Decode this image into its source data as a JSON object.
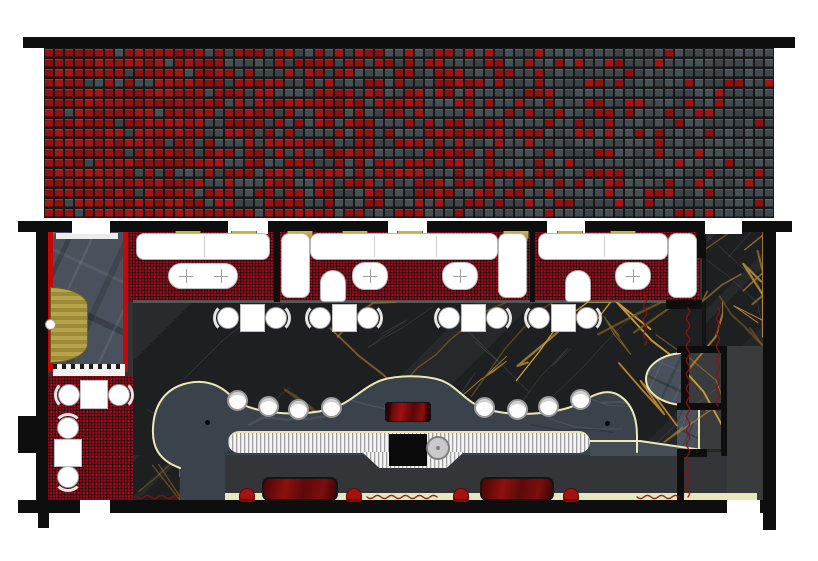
{
  "meta": {
    "type": "architectural-floor-plan",
    "subject": "restaurant-lounge interior plan with red-to-charcoal mosaic facade band, booth seating, curved bar and stage",
    "canvas": {
      "w": 818,
      "h": 561
    },
    "render_seed": 1337
  },
  "palette": {
    "wall": "#0e0e0e",
    "mosaic_red": "#9b1212",
    "mosaic_gray": "#424b4f",
    "mosaic_grout": "#161819",
    "carpet_red": "#850e1b",
    "marble_black": "#1d1f21",
    "marble_gold_vein": "#b8862e",
    "slate_gray": "#49525c",
    "service_gray": "#333538",
    "corridor_gray": "#3a3b3d",
    "cream_outline": "#ece9b6",
    "banquette_yellow": "#e4e7bf",
    "furniture_white": "#ffffff",
    "glossy_bench_red": "#8e1010",
    "stool_red": "#a51310",
    "door_gold": "#b7a34b",
    "metal_counter": "#dcdcdc"
  },
  "inventory": {
    "mosaic_band": "gradient tile mosaic, red at left fading to charcoal at right",
    "booth_sections": 3,
    "booth_wall_lamps": 8,
    "booth_oval_tables": 4,
    "booth_arch_chairs": 2,
    "dining_table_sets": 4,
    "side_room_tables": 2,
    "bar_stools": 8,
    "lounge_benches": 2,
    "lounge_floor_stools": 4,
    "stage_semicircles": 1,
    "entry_door_swings": 1,
    "top_door_openings": 5,
    "bottom_door_openings": 2
  },
  "mosaic": {
    "x": 44,
    "y": 48,
    "w": 730,
    "h": 170,
    "cols": 73,
    "rows": 17,
    "red_shades": [
      "#9b1212",
      "#8c1010",
      "#a41616",
      "#931111"
    ],
    "gray_shades": [
      "#424b4f",
      "#3b4347",
      "#475054",
      "#3f474b"
    ],
    "red_fraction_left": 0.97,
    "red_fraction_right": 0.04
  },
  "structure": {
    "zones": [
      {
        "name": "interior-floor-base",
        "x": 48,
        "y": 231,
        "w": 719,
        "h": 274,
        "css": "flat1"
      },
      {
        "name": "vestibule-floor",
        "x": 53,
        "y": 232,
        "w": 70,
        "h": 140,
        "css": "slate"
      },
      {
        "name": "vestibule-red-wall-left",
        "x": 48,
        "y": 232,
        "w": 5,
        "h": 140,
        "css": "redstrip"
      },
      {
        "name": "vestibule-red-wall-right",
        "x": 123,
        "y": 232,
        "w": 5,
        "h": 140,
        "css": "redstrip"
      },
      {
        "name": "vestibule-entry-mat",
        "x": 56,
        "y": 233,
        "w": 62,
        "h": 6,
        "css": "mat"
      },
      {
        "name": "vestibule-threshold",
        "x": 53,
        "y": 364,
        "w": 72,
        "h": 12,
        "css": "threshold"
      },
      {
        "name": "booth-carpet",
        "x": 128,
        "y": 232,
        "w": 572,
        "h": 70,
        "css": "carpet"
      },
      {
        "name": "marble-dining-floor",
        "x": 133,
        "y": 302,
        "w": 590,
        "h": 153,
        "css": "marble"
      },
      {
        "name": "marble-right-panel",
        "x": 702,
        "y": 230,
        "w": 61,
        "h": 116,
        "css": "marble panelL"
      },
      {
        "name": "carpet-edge-line",
        "x": 133,
        "y": 300,
        "w": 567,
        "h": 3,
        "css": "line"
      },
      {
        "name": "side-room-carpet",
        "x": 48,
        "y": 376,
        "w": 85,
        "h": 124,
        "css": "carpet"
      },
      {
        "name": "marble-walkway",
        "x": 133,
        "y": 455,
        "w": 47,
        "h": 45,
        "css": "marble"
      },
      {
        "name": "service-lounge-floor",
        "x": 225,
        "y": 452,
        "w": 532,
        "h": 53,
        "css": "flat2"
      },
      {
        "name": "east-corridor-floor",
        "x": 727,
        "y": 346,
        "w": 36,
        "h": 159,
        "css": "flat3"
      },
      {
        "name": "alcove-1-floor",
        "x": 689,
        "y": 353,
        "w": 32,
        "h": 50,
        "css": "flat3"
      },
      {
        "name": "alcove-2-slate",
        "x": 677,
        "y": 410,
        "w": 23,
        "h": 39,
        "css": "slate alc-slate"
      },
      {
        "name": "alcove-2-floor",
        "x": 700,
        "y": 410,
        "w": 21,
        "h": 39,
        "css": "flat3"
      },
      {
        "name": "banquette-strip",
        "x": 225,
        "y": 493,
        "w": 532,
        "h": 11,
        "css": "banq"
      }
    ],
    "walls": [
      {
        "name": "top-facade-wall",
        "x": 23,
        "y": 37,
        "w": 772,
        "h": 11
      },
      {
        "name": "interior-top-wall",
        "x": 18,
        "y": 221,
        "w": 774,
        "h": 11
      },
      {
        "name": "bottom-wall",
        "x": 18,
        "y": 500,
        "w": 745,
        "h": 13
      },
      {
        "name": "left-wall",
        "x": 36,
        "y": 231,
        "w": 12,
        "h": 269
      },
      {
        "name": "left-pillar",
        "x": 18,
        "y": 416,
        "w": 18,
        "h": 37
      },
      {
        "name": "left-wall-stub",
        "x": 38,
        "y": 513,
        "w": 11,
        "h": 15
      },
      {
        "name": "right-wall",
        "x": 763,
        "y": 227,
        "w": 13,
        "h": 303
      },
      {
        "name": "booth-end-wall",
        "x": 697,
        "y": 227,
        "w": 9,
        "h": 31
      },
      {
        "name": "booth-bottom-wall",
        "x": 666,
        "y": 300,
        "w": 36,
        "h": 9
      },
      {
        "name": "alcove-top-wall",
        "x": 677,
        "y": 346,
        "w": 47,
        "h": 7
      },
      {
        "name": "alcove-left-wall",
        "x": 681,
        "y": 349,
        "w": 8,
        "h": 57
      },
      {
        "name": "alcove-mid-wall",
        "x": 677,
        "y": 403,
        "w": 47,
        "h": 7
      },
      {
        "name": "alcove-low-wall",
        "x": 677,
        "y": 449,
        "w": 30,
        "h": 8
      },
      {
        "name": "alcove-divider-wall",
        "x": 721,
        "y": 346,
        "w": 6,
        "h": 110
      },
      {
        "name": "service-step-wall",
        "x": 677,
        "y": 452,
        "w": 7,
        "h": 51
      },
      {
        "name": "booth-divider-1",
        "x": 274,
        "y": 232,
        "w": 6,
        "h": 70
      },
      {
        "name": "booth-divider-2",
        "x": 530,
        "y": 232,
        "w": 5,
        "h": 70
      }
    ],
    "door_gaps_top": [
      {
        "x": 72,
        "y": 219,
        "w": 38,
        "h": 15
      },
      {
        "x": 228,
        "y": 219,
        "w": 40,
        "h": 15
      },
      {
        "x": 388,
        "y": 219,
        "w": 39,
        "h": 15
      },
      {
        "x": 547,
        "y": 219,
        "w": 38,
        "h": 15
      },
      {
        "x": 705,
        "y": 219,
        "w": 37,
        "h": 15
      }
    ],
    "door_gaps_bottom": [
      {
        "x": 80,
        "y": 500,
        "w": 30,
        "h": 14
      },
      {
        "x": 727,
        "y": 500,
        "w": 33,
        "h": 14
      }
    ]
  },
  "bar": {
    "body_path": "M 180 505 L 180 468 C 158 460 152 446 153 428 C 154 406 164 390 184 384 C 206 378 222 386 233 398 C 247 413 298 418 330 409 C 352 403 362 387 382 380 C 398 375 424 375 440 380 C 458 386 464 402 486 409 C 516 418 562 414 584 401 C 597 392 610 389 620 396 C 632 404 637 418 637 436 L 637 455 L 225 455 L 225 505 Z",
    "outline_path": "M 180 468 C 158 460 152 446 153 428 C 154 406 164 390 184 384 C 206 378 222 386 233 398 C 247 413 298 418 330 409 C 352 403 362 387 382 380 C 398 375 424 375 440 380 C 458 386 464 402 486 409 C 516 418 562 414 584 401 C 597 392 610 389 620 396 C 632 404 637 418 637 436 L 637 452",
    "wedge_path": "M 590 440 L 640 440 L 702 449 L 702 456 L 590 456 Z",
    "wedge_outline": "M 590 441 L 640 441 L 702 450",
    "body_fill": "#3a434c",
    "counter": {
      "x": 228,
      "y": 431,
      "w": 362,
      "h": 22
    },
    "counter_trapezoid": {
      "x": 362,
      "y": 452,
      "w": 102,
      "h": 16
    },
    "station_box": {
      "x": 389,
      "y": 434,
      "w": 38,
      "h": 32
    },
    "sink": {
      "x": 426,
      "y": 436
    },
    "glossy_tray": {
      "x": 385,
      "y": 402,
      "w": 46,
      "h": 20
    },
    "drain_dots": [
      [
        207,
        422
      ],
      [
        607,
        423
      ]
    ],
    "stools": [
      [
        237,
        400
      ],
      [
        268,
        406
      ],
      [
        298,
        409
      ],
      [
        331,
        407
      ],
      [
        484,
        407
      ],
      [
        517,
        409
      ],
      [
        548,
        406
      ],
      [
        580,
        399
      ]
    ]
  },
  "booths": {
    "lamps_x": [
      188,
      244,
      300,
      355,
      410,
      516,
      570,
      623
    ],
    "lamps_y": 231,
    "sofas": [
      {
        "name": "booth-sofa",
        "x": 136,
        "y": 233,
        "w": 134,
        "h": 27,
        "div": [
          203
        ]
      },
      {
        "name": "booth-sofa-arm",
        "x": 281,
        "y": 233,
        "w": 29,
        "h": 65,
        "div": []
      },
      {
        "name": "booth-sofa",
        "x": 310,
        "y": 233,
        "w": 188,
        "h": 27,
        "div": [
          373,
          435
        ]
      },
      {
        "name": "booth-sofa-arm",
        "x": 498,
        "y": 233,
        "w": 29,
        "h": 65,
        "div": []
      },
      {
        "name": "booth-sofa",
        "x": 538,
        "y": 233,
        "w": 130,
        "h": 27,
        "div": [
          603
        ]
      },
      {
        "name": "booth-sofa-arm",
        "x": 668,
        "y": 233,
        "w": 29,
        "h": 65,
        "div": []
      }
    ],
    "tables": [
      {
        "x": 168,
        "y": 263,
        "w": 70,
        "h": 26,
        "r": 13,
        "marks": [
          [
            186,
            276
          ],
          [
            221,
            276
          ]
        ]
      },
      {
        "x": 352,
        "y": 262,
        "w": 36,
        "h": 28,
        "r": 13,
        "marks": [
          [
            370,
            276
          ]
        ]
      },
      {
        "x": 442,
        "y": 262,
        "w": 36,
        "h": 28,
        "r": 13,
        "marks": [
          [
            460,
            276
          ]
        ]
      },
      {
        "x": 615,
        "y": 262,
        "w": 36,
        "h": 28,
        "r": 13,
        "marks": [
          [
            633,
            276
          ]
        ]
      }
    ],
    "arch_chairs": [
      {
        "x": 320,
        "y": 270,
        "w": 26,
        "h": 32
      },
      {
        "x": 565,
        "y": 270,
        "w": 26,
        "h": 32
      }
    ]
  },
  "dining": {
    "set_centers_x": [
      252,
      344,
      473,
      563
    ],
    "cy": 318,
    "table": {
      "w": 25,
      "h": 28
    }
  },
  "side_room": {
    "tables": [
      {
        "x": 80,
        "y": 380,
        "w": 28,
        "h": 29
      },
      {
        "x": 54,
        "y": 439,
        "w": 28,
        "h": 28
      }
    ],
    "chairs": [
      {
        "cx": 69,
        "cy": 395,
        "ring": "rl"
      },
      {
        "cx": 119,
        "cy": 395,
        "ring": "rr"
      },
      {
        "cx": 68,
        "cy": 428,
        "ring": "rt"
      },
      {
        "cx": 68,
        "cy": 477,
        "ring": "rb"
      }
    ]
  },
  "entry": {
    "door_swing": {
      "x": 50,
      "y": 287,
      "w": 38,
      "h": 76
    },
    "hinge": {
      "x": 45,
      "y": 319
    }
  },
  "stage": {
    "x": 645,
    "y": 352,
    "w": 40,
    "h": 54
  },
  "lounge": {
    "benches": [
      {
        "x": 262,
        "y": 477,
        "w": 76,
        "h": 24
      },
      {
        "x": 480,
        "y": 477,
        "w": 74,
        "h": 24
      }
    ],
    "floor_stools": [
      [
        247,
        488
      ],
      [
        354,
        488
      ],
      [
        461,
        488
      ],
      [
        571,
        488
      ]
    ]
  },
  "squiggles": {
    "color": "#8a1212",
    "vertical": [
      {
        "x": 645,
        "y1": 296,
        "y2": 342
      },
      {
        "x": 688,
        "y1": 308,
        "y2": 496
      },
      {
        "x": 718,
        "y1": 308,
        "y2": 404
      }
    ],
    "horizontal": [
      {
        "y": 497,
        "x1": 137,
        "x2": 177
      },
      {
        "y": 497,
        "x1": 367,
        "x2": 432
      },
      {
        "y": 497,
        "x1": 637,
        "x2": 677
      }
    ]
  },
  "veins": {
    "regions": [
      {
        "name": "marble-dining-floor",
        "x": 133,
        "y": 302,
        "w": 590,
        "h": 153,
        "gold": 18,
        "crack": 10
      },
      {
        "name": "marble-right-panel",
        "x": 702,
        "y": 230,
        "w": 61,
        "h": 116,
        "gold": 9,
        "crack": 3
      },
      {
        "name": "marble-walkway",
        "x": 133,
        "y": 455,
        "w": 47,
        "h": 45,
        "gold": 3,
        "crack": 2
      }
    ],
    "gold_shades": [
      "#b8862e",
      "#d2a039",
      "#8a6420"
    ],
    "crack_color": "#8fa0a5"
  }
}
